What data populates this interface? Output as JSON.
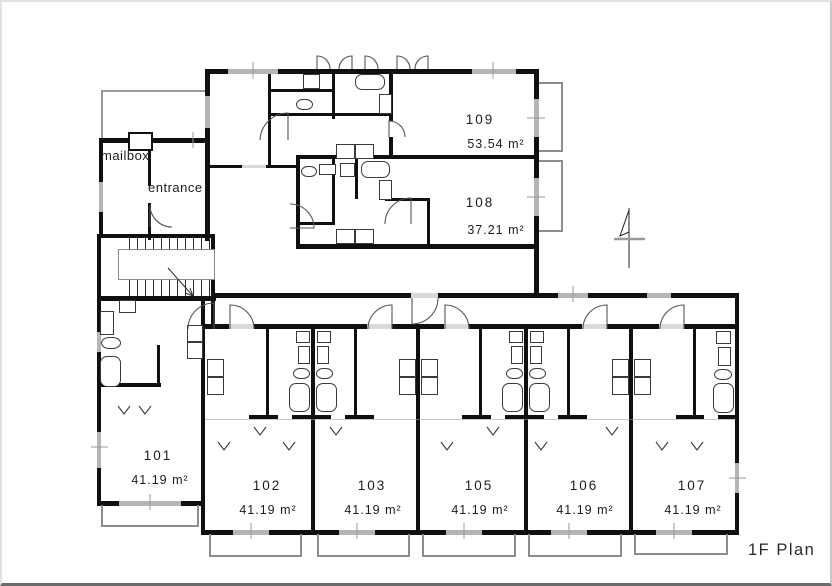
{
  "plan": {
    "title": "1F Plan",
    "labels": {
      "mailbox": "mailbox",
      "entrance": "entrance"
    },
    "units": [
      {
        "id": "101",
        "area": "41.19 m²"
      },
      {
        "id": "102",
        "area": "41.19 m²"
      },
      {
        "id": "103",
        "area": "41.19 m²"
      },
      {
        "id": "105",
        "area": "41.19 m²"
      },
      {
        "id": "106",
        "area": "41.19 m²"
      },
      {
        "id": "107",
        "area": "41.19 m²"
      },
      {
        "id": "108",
        "area": "37.21 m²"
      },
      {
        "id": "109",
        "area": "53.54 m²"
      }
    ],
    "colors": {
      "wall": "#101010",
      "window_fill": "#b5b5b5",
      "balcony_line": "#8d8d8d",
      "text": "#1c1c1c"
    }
  }
}
